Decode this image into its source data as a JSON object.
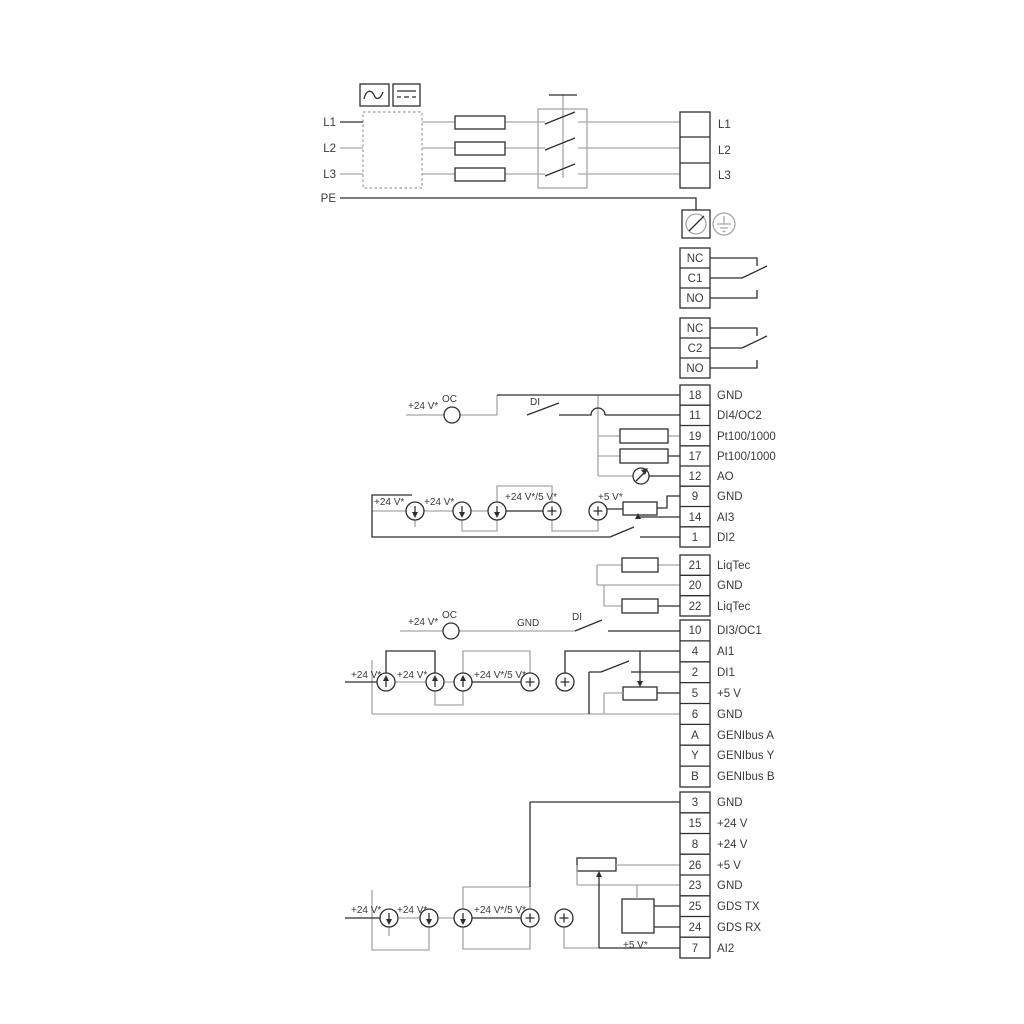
{
  "ann": {
    "v24": "+24 V*",
    "oc": "OC",
    "di": "DI",
    "gnd": "GND",
    "v24_5": "+24 V*/5 V*",
    "v5": "+5 V*"
  },
  "mains": {
    "inputs": [
      "L1",
      "L2",
      "L3",
      "PE"
    ],
    "outputs": [
      "L1",
      "L2",
      "L3"
    ]
  },
  "relays": {
    "relay1": [
      "NC",
      "C1",
      "NO"
    ],
    "relay2": [
      "NC",
      "C2",
      "NO"
    ]
  },
  "strips": {
    "io1": [
      {
        "num": "18",
        "label": "GND"
      },
      {
        "num": "11",
        "label": "DI4/OC2"
      },
      {
        "num": "19",
        "label": "Pt100/1000"
      },
      {
        "num": "17",
        "label": "Pt100/1000"
      },
      {
        "num": "12",
        "label": "AO"
      },
      {
        "num": "9",
        "label": "GND"
      },
      {
        "num": "14",
        "label": "AI3"
      },
      {
        "num": "1",
        "label": "DI2"
      }
    ],
    "liqtec": [
      {
        "num": "21",
        "label": "LiqTec"
      },
      {
        "num": "20",
        "label": "GND"
      },
      {
        "num": "22",
        "label": "LiqTec"
      }
    ],
    "io2": [
      {
        "num": "10",
        "label": "DI3/OC1"
      },
      {
        "num": "4",
        "label": "AI1"
      },
      {
        "num": "2",
        "label": "DI1"
      },
      {
        "num": "5",
        "label": "+5 V"
      },
      {
        "num": "6",
        "label": "GND"
      },
      {
        "num": "A",
        "label": "GENIbus A"
      },
      {
        "num": "Y",
        "label": "GENIbus Y"
      },
      {
        "num": "B",
        "label": "GENIbus B"
      }
    ],
    "io3": [
      {
        "num": "3",
        "label": "GND"
      },
      {
        "num": "15",
        "label": "+24 V"
      },
      {
        "num": "8",
        "label": "+24 V"
      },
      {
        "num": "26",
        "label": "+5 V"
      },
      {
        "num": "23",
        "label": "GND"
      },
      {
        "num": "25",
        "label": "GDS TX"
      },
      {
        "num": "24",
        "label": "GDS RX"
      },
      {
        "num": "7",
        "label": "AI2"
      }
    ]
  },
  "icons": {
    "ac_filter": "sine-wave",
    "dc_filter": "dc-lines",
    "screw_terminal": "circle-slash",
    "earth_ground": "earth-symbol",
    "current_source_down": "circle-arrow-down",
    "current_source_up": "circle-arrow-up",
    "voltage_source": "circle-plus",
    "analog_output_meter": "circle-needle"
  },
  "colors": {
    "wire_dark": "#2e2e2e",
    "wire_gray": "#a6a6a6",
    "background": "#ffffff"
  }
}
